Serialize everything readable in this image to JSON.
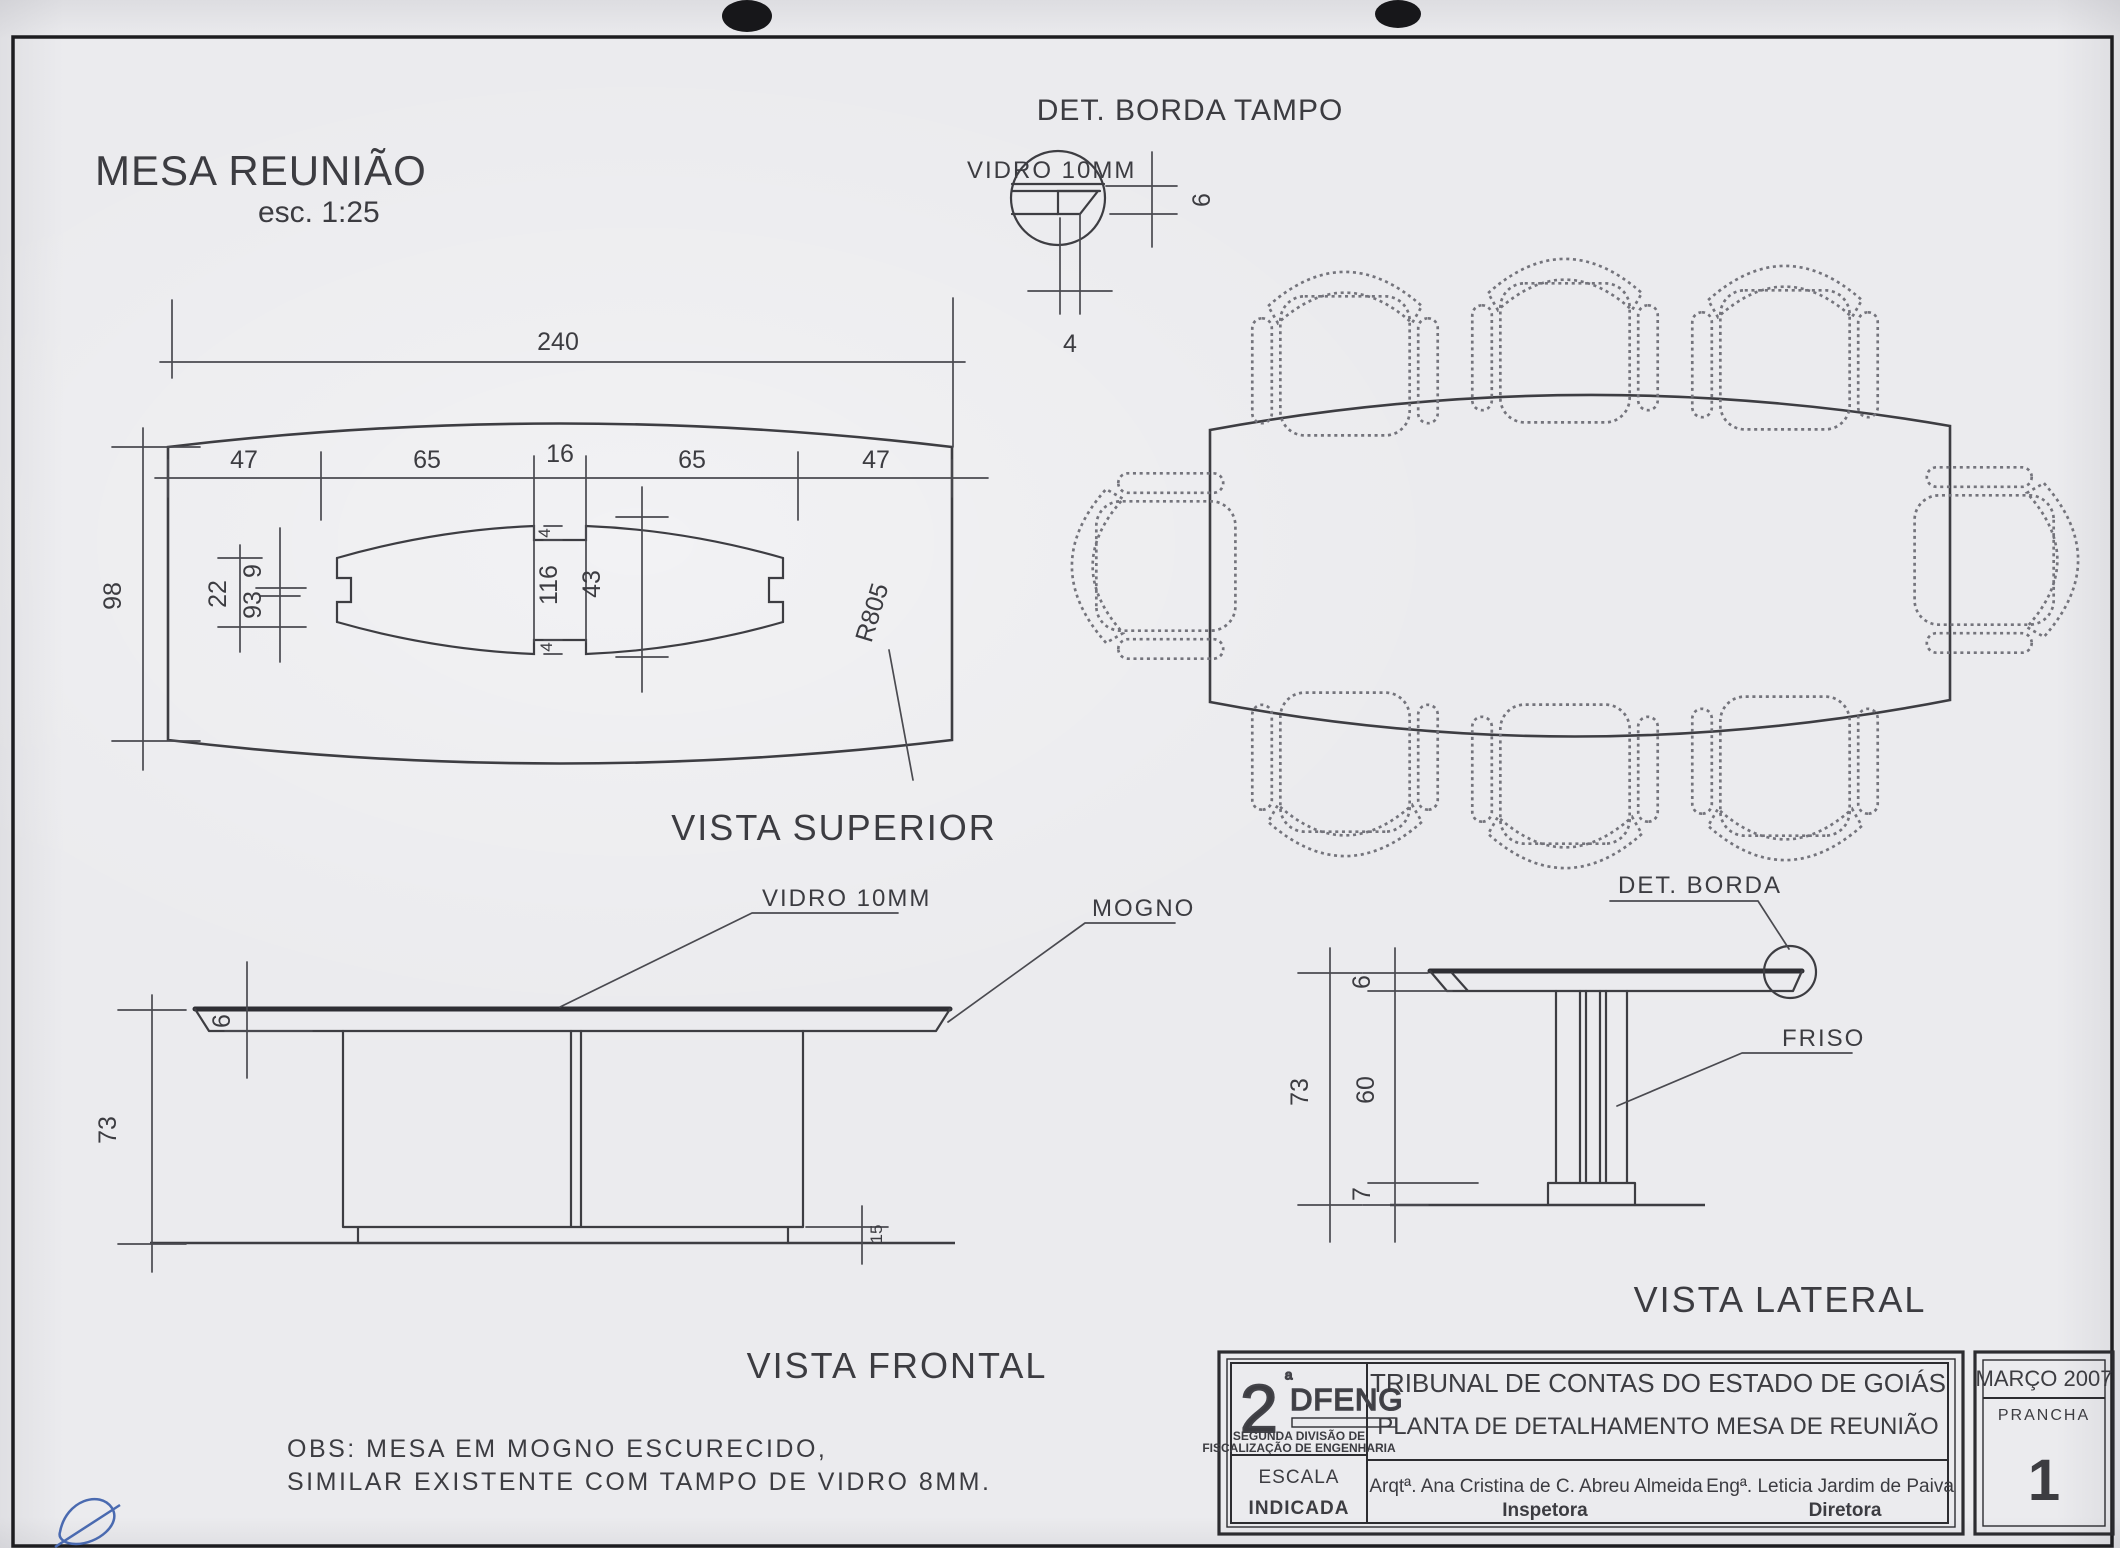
{
  "sheet": {
    "title": "MESA REUNIÃO",
    "scale_note": "esc. 1:25"
  },
  "detail_top": {
    "title": "DET. BORDA TAMPO",
    "vidro_label": "VIDRO 10MM",
    "dim_thickness": "6",
    "dim_edge": "4"
  },
  "top_view": {
    "caption": "VISTA SUPERIOR",
    "dim_total": "240",
    "dims_row": [
      "47",
      "65",
      "16",
      "65",
      "47"
    ],
    "dim_depth": "98",
    "dim_22": "22",
    "dim_9": "9",
    "dim_93": "93",
    "dim_116": "116",
    "dim_43": "43",
    "dim_notch_top": "4",
    "dim_notch_bottom": "4",
    "radius_label": "R805"
  },
  "front_view": {
    "caption": "VISTA FRONTAL",
    "vidro_label": "VIDRO 10MM",
    "mogno_label": "MOGNO",
    "dim_top": "6",
    "dim_height": "73",
    "dim_base": "15"
  },
  "side_view": {
    "caption": "VISTA LATERAL",
    "det_borda_label": "DET. BORDA",
    "friso_label": "FRISO",
    "dim_top": "6",
    "dim_height": "73",
    "dim_column": "60",
    "dim_base": "7"
  },
  "notes": {
    "line1": "OBS:  MESA  EM  MOGNO  ESCURECIDO,",
    "line2": "SIMILAR  EXISTENTE  COM  TAMPO  DE  VIDRO  8MM."
  },
  "title_block": {
    "logo_number": "2",
    "logo_sup": "ª",
    "logo_name": "DFENG",
    "division_line1": "SEGUNDA DIVISÃO DE",
    "division_line2": "FISCALIZAÇÃO DE ENGENHARIA",
    "escala_label": "ESCALA",
    "escala_value": "INDICADA",
    "org_name": "TRIBUNAL DE CONTAS DO ESTADO DE GOIÁS",
    "drawing_title": "PLANTA DE DETALHAMENTO MESA DE REUNIÃO",
    "author_left": "Arqtª. Ana Cristina de C. Abreu Almeida",
    "author_right": "Engª. Leticia Jardim de Paiva",
    "role_left": "Inspetora",
    "role_right": "Diretora",
    "date": "MARÇO 2007",
    "sheet_label": "PRANCHA",
    "sheet_number": "1"
  }
}
